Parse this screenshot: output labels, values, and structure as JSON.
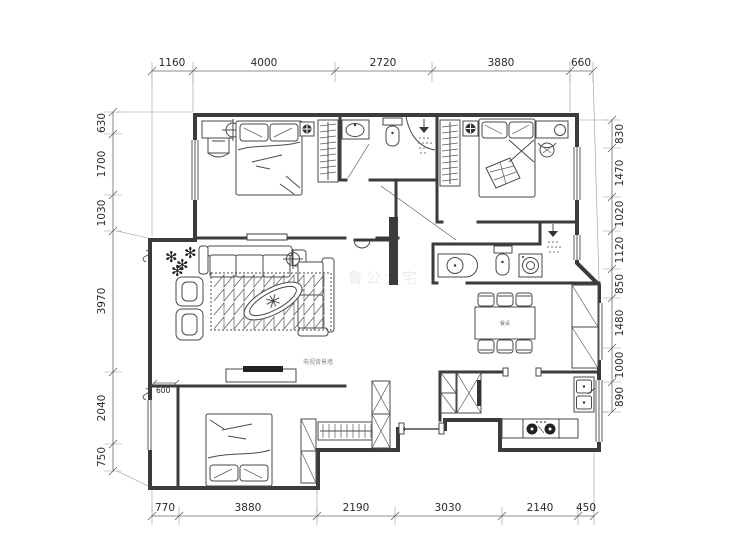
{
  "title": "apartment-floor-plan",
  "dimensions": {
    "top": [
      "1160",
      "4000",
      "2720",
      "3880",
      "660"
    ],
    "bottom": [
      "770",
      "3880",
      "2190",
      "3030",
      "2140",
      "450"
    ],
    "left": [
      "630",
      "1700",
      "1030",
      "3970",
      "2040",
      "750"
    ],
    "right": [
      "830",
      "1470",
      "1020",
      "1120",
      "850",
      "1480",
      "1000",
      "890"
    ],
    "inline_balcony": "600"
  },
  "annotations": {
    "tv_wall_label": "电视背景墙",
    "dining_table_label": "餐桌",
    "watermark": "鲁公大宅"
  },
  "colors": {
    "wall": "#3b3b3b",
    "furniture_line": "#4a4a4a",
    "dimension_text": "#2a2a2a",
    "background": "#ffffff"
  }
}
